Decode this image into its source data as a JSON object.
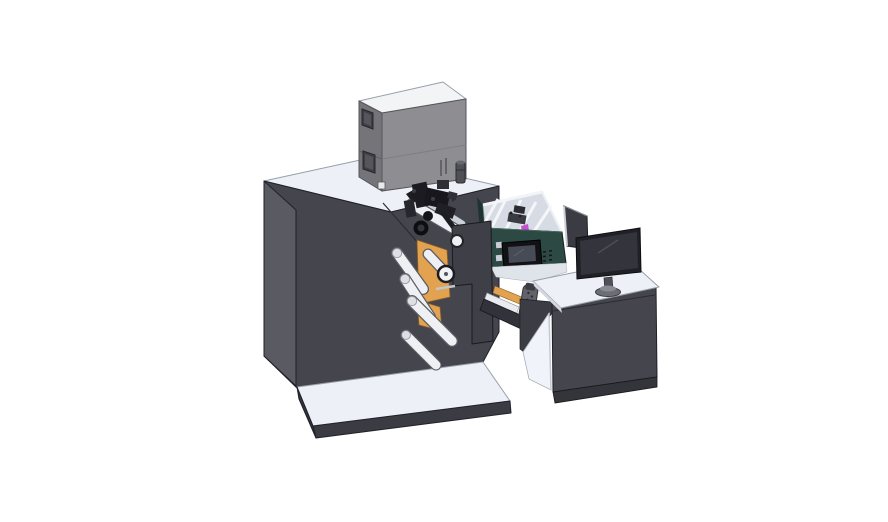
{
  "scene": {
    "description": "Isometric 3D CAD render of a compact label printing and rewinding machine with an operator desk, shown on a plain white background",
    "view": "isometric",
    "background": "#ffffff",
    "components": [
      {
        "id": "main-cabinet",
        "label": "Main machine cabinet"
      },
      {
        "id": "base-platform",
        "label": "Machine base platform"
      },
      {
        "id": "top-enclosure",
        "label": "Top equipment enclosure box"
      },
      {
        "id": "printhead-mechanism",
        "label": "Print head mechanism cluster"
      },
      {
        "id": "guide-rollers",
        "label": "White web guide rollers"
      },
      {
        "id": "unwinder-side-plates",
        "label": "Orange unwinder side plates"
      },
      {
        "id": "front-guard-plate",
        "label": "Stepped front guard plate"
      },
      {
        "id": "feeder-module",
        "label": "Green feeder tray module with divider plates"
      },
      {
        "id": "hmi-screen",
        "label": "Small HMI control screen"
      },
      {
        "id": "output-chute",
        "label": "Output chute ramp"
      },
      {
        "id": "mounting-bracket",
        "label": "Gray mounting bracket"
      },
      {
        "id": "operator-desk",
        "label": "Operator desk cabinet"
      },
      {
        "id": "desktop-monitor",
        "label": "Desktop monitor on stand"
      },
      {
        "id": "rear-display-panel",
        "label": "Rear angled display panel"
      }
    ],
    "colors": {
      "cabinet_front": "#45454e",
      "cabinet_side": "#5a5a63",
      "cabinet_right": "#4c4c56",
      "surface_top": "#edf0f7",
      "enclosure_front": "#8e8e92",
      "enclosure_side": "#757579",
      "enclosure_top": "#f3f4f6",
      "accent_orange": "#e2a24f",
      "module_green": "#2c4a43",
      "tray_light": "#d7dce4",
      "roller_white": "#eef0f4",
      "roller_outline": "#595c63",
      "hardware_black": "#16161b",
      "monitor_dark": "#202027",
      "magenta_detail": "#c44fcf"
    }
  }
}
